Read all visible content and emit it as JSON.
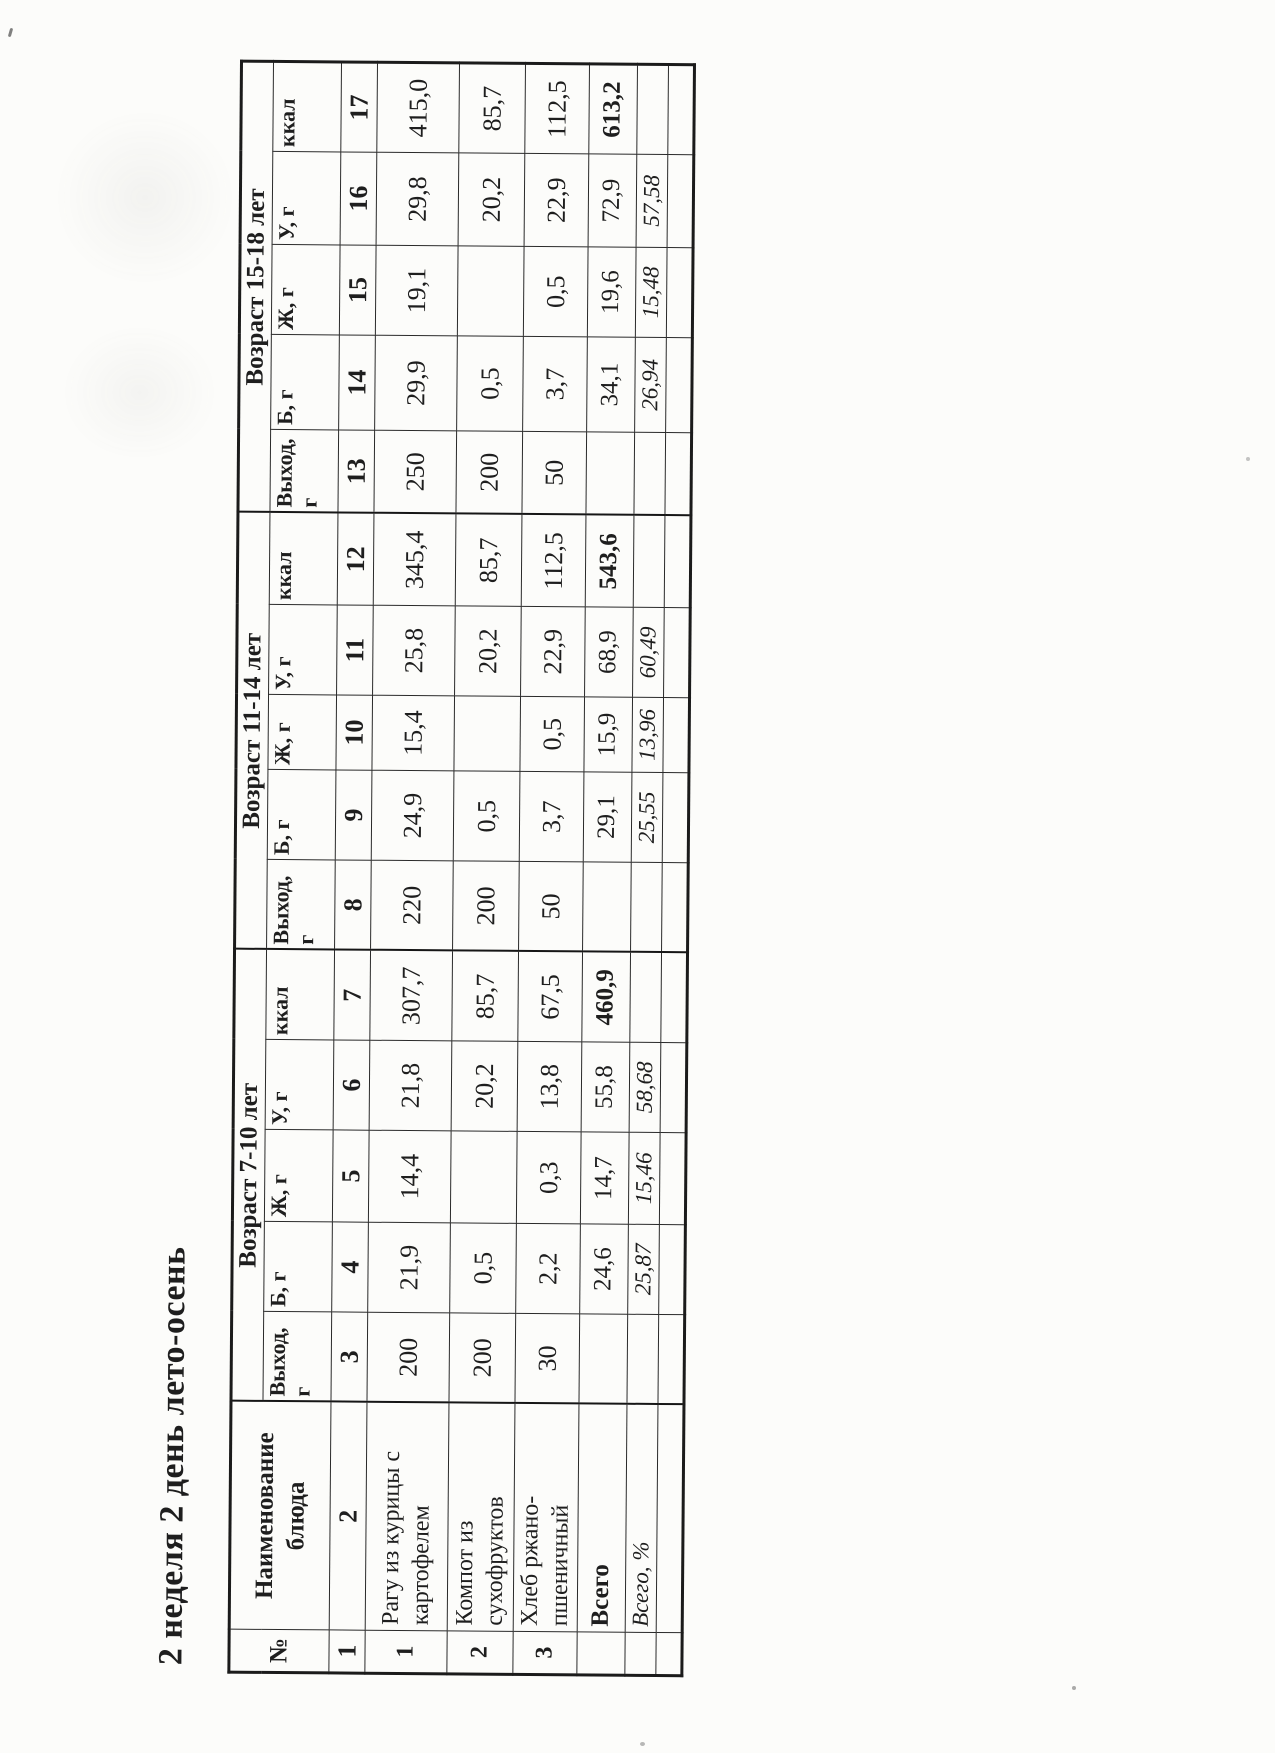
{
  "title": "2 неделя 2 день лето-осень",
  "colors": {
    "ink": "#1e1e1e",
    "paper": "#fcfcfa"
  },
  "table": {
    "corner_label": "№",
    "name_header": "Наименование\nблюда",
    "groups": [
      {
        "label": "Возраст 7-10 лет",
        "cols": [
          "Выход, г",
          "Б, г",
          "Ж, г",
          "У, г",
          "ккал"
        ]
      },
      {
        "label": "Возраст 11-14 лет",
        "cols": [
          "Выход,\nг",
          "Б, г",
          "Ж, г",
          "У, г",
          "ккал"
        ]
      },
      {
        "label": "Возраст 15-18 лет",
        "cols": [
          "Выход,\nг",
          "Б, г",
          "Ж, г",
          "У, г",
          "ккал"
        ]
      }
    ],
    "number_row": [
      "1",
      "2",
      "3",
      "4",
      "5",
      "6",
      "7",
      "8",
      "9",
      "10",
      "11",
      "12",
      "13",
      "14",
      "15",
      "16",
      "17"
    ],
    "rows": [
      {
        "num": "1",
        "name": "Рагу из курицы с картофелем",
        "values": [
          "200",
          "21,9",
          "14,4",
          "21,8",
          "307,7",
          "220",
          "24,9",
          "15,4",
          "25,8",
          "345,4",
          "250",
          "29,9",
          "19,1",
          "29,8",
          "415,0"
        ]
      },
      {
        "num": "2",
        "name": "Компот из сухофруктов",
        "values": [
          "200",
          "0,5",
          "",
          "20,2",
          "85,7",
          "200",
          "0,5",
          "",
          "20,2",
          "85,7",
          "200",
          "0,5",
          "",
          "20,2",
          "85,7"
        ]
      },
      {
        "num": "3",
        "name": "Хлеб ржано-пшеничный",
        "values": [
          "30",
          "2,2",
          "0,3",
          "13,8",
          "67,5",
          "50",
          "3,7",
          "0,5",
          "22,9",
          "112,5",
          "50",
          "3,7",
          "0,5",
          "22,9",
          "112,5"
        ]
      }
    ],
    "total_row": {
      "label": "Всего",
      "values": [
        "",
        "24,6",
        "14,7",
        "55,8",
        "460,9",
        "",
        "29,1",
        "15,9",
        "68,9",
        "543,6",
        "",
        "34,1",
        "19,6",
        "72,9",
        "613,2"
      ]
    },
    "percent_row": {
      "label": "Всего, %",
      "values": [
        "",
        "25,87",
        "15,46",
        "58,68",
        "",
        "",
        "25,55",
        "13,96",
        "60,49",
        "",
        "",
        "26,94",
        "15,48",
        "57,58",
        ""
      ]
    },
    "empty_row": [
      "",
      "",
      "",
      "",
      "",
      "",
      "",
      "",
      "",
      "",
      "",
      "",
      "",
      "",
      "",
      "",
      ""
    ]
  }
}
